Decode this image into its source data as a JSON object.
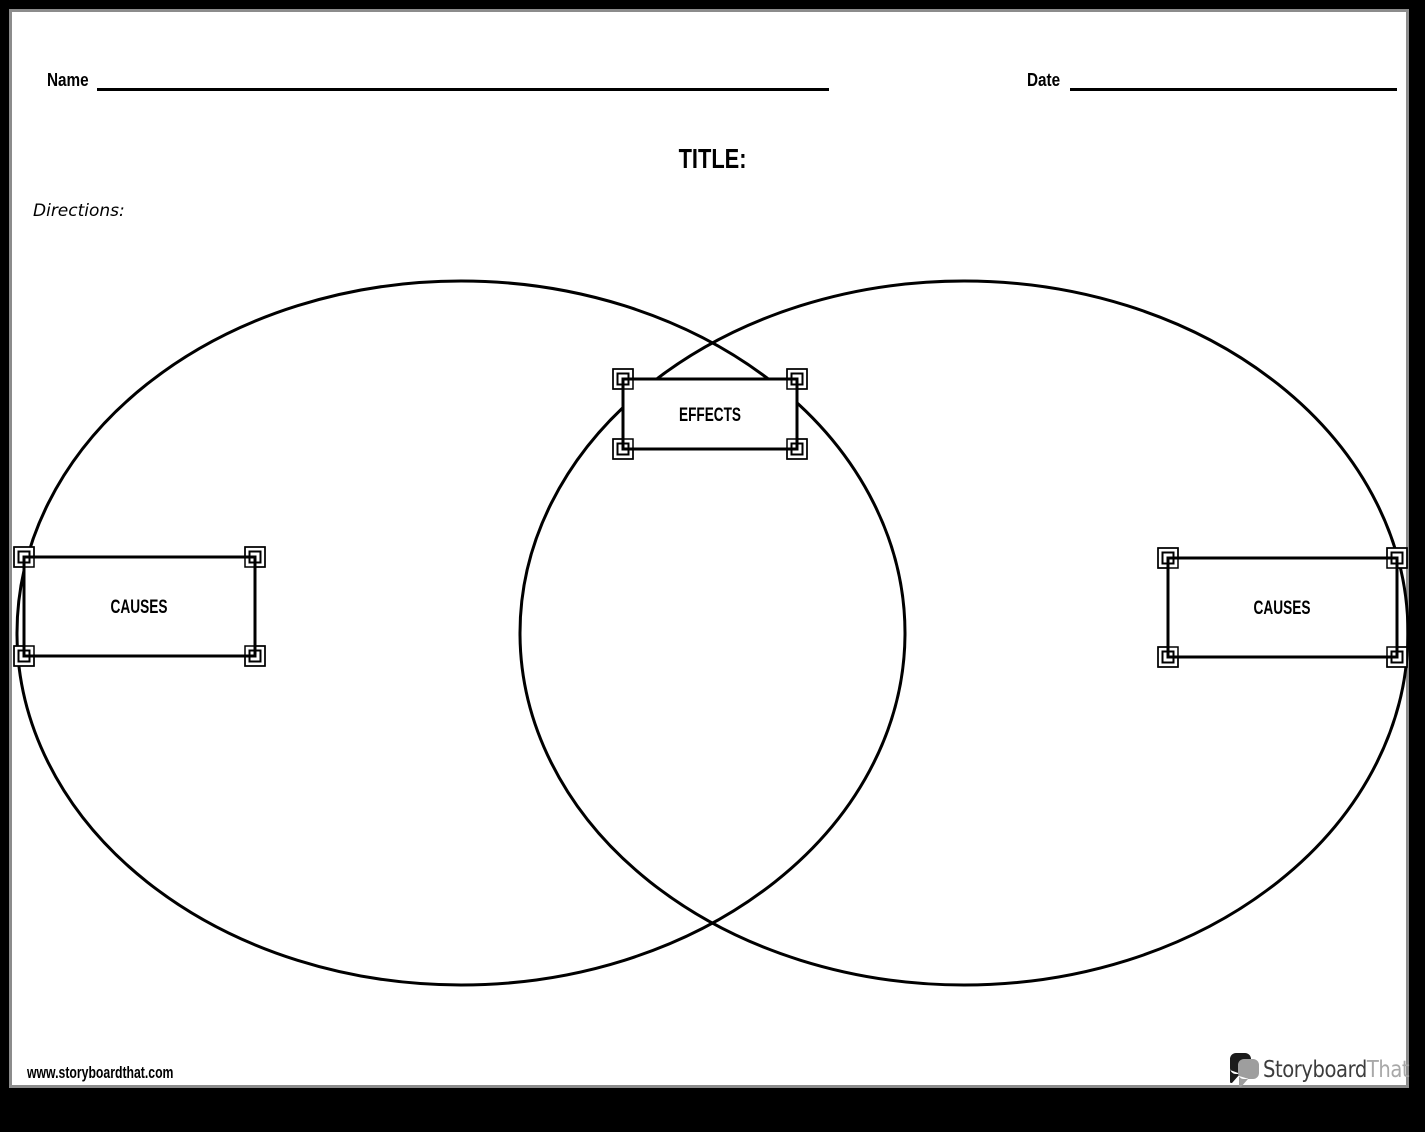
{
  "header": {
    "name_label": "Name",
    "date_label": "Date",
    "title_label": "TITLE:",
    "directions_label": "Directions:"
  },
  "diagram": {
    "type": "venn-diagram-cause-effect",
    "effects_label": "EFFECTS",
    "causes_left_label": "CAUSES",
    "causes_right_label": "CAUSES"
  },
  "footer": {
    "website_url": "www.storyboardthat.com",
    "logo": {
      "text_primary": "Storyboard",
      "text_secondary": "That",
      "icon": "speech-bubbles-icon"
    }
  },
  "colors": {
    "ink": "#000000",
    "page": "#ffffff",
    "frame": "#000000",
    "frame_shadow": "#8c8c8c",
    "logo_text_primary": "#3d3d3d",
    "logo_text_secondary": "#a8a8a8",
    "logo_bubble_dark": "#1b1b1b",
    "logo_bubble_light": "#9e9e9e"
  }
}
